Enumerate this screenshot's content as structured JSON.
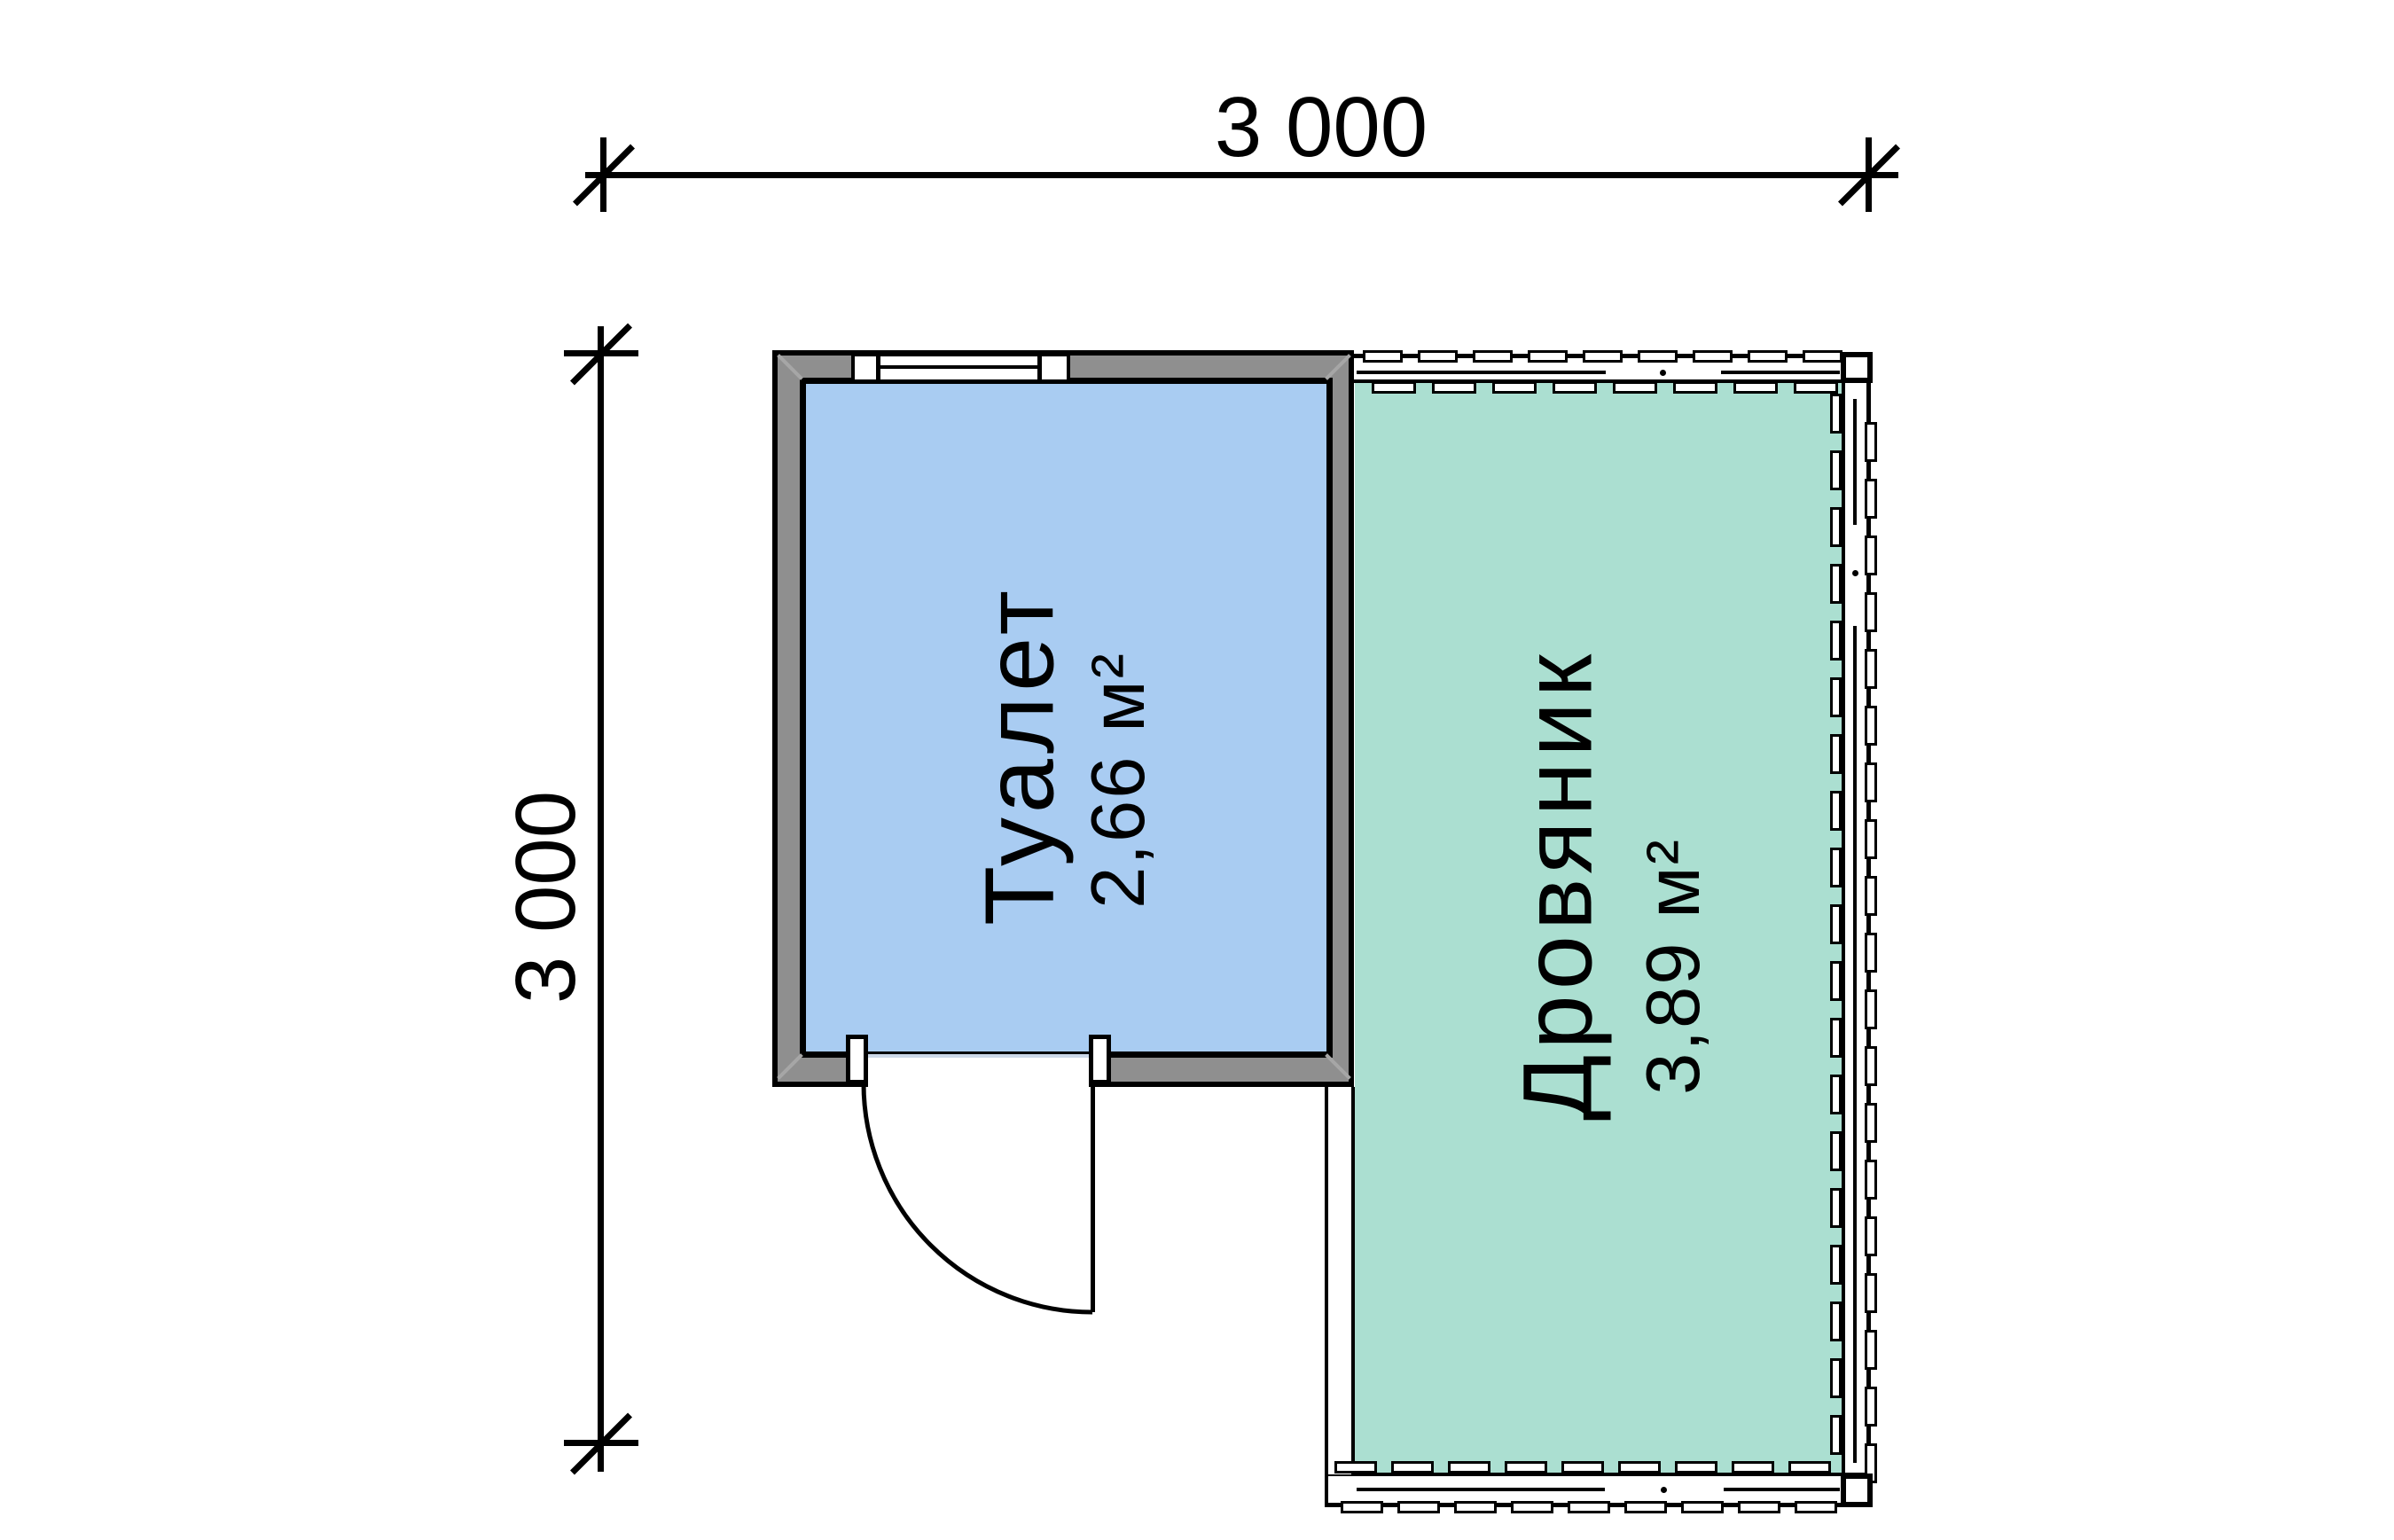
{
  "dimensions": {
    "top": {
      "label": "3 000"
    },
    "left": {
      "label": "3 000"
    }
  },
  "rooms": [
    {
      "name": "Туалет",
      "area": "2,66 м²",
      "floor_color": "#a9ccf2"
    },
    {
      "name": "Дровяник",
      "area": "3,89 м²",
      "floor_color": "#abdfd1"
    }
  ],
  "colors": {
    "wall_gray": "#8f8f8f",
    "outline": "#000000",
    "toilet_floor": "#a9ccf2",
    "woodshed_floor": "#abdfd1",
    "background": "#ffffff"
  }
}
